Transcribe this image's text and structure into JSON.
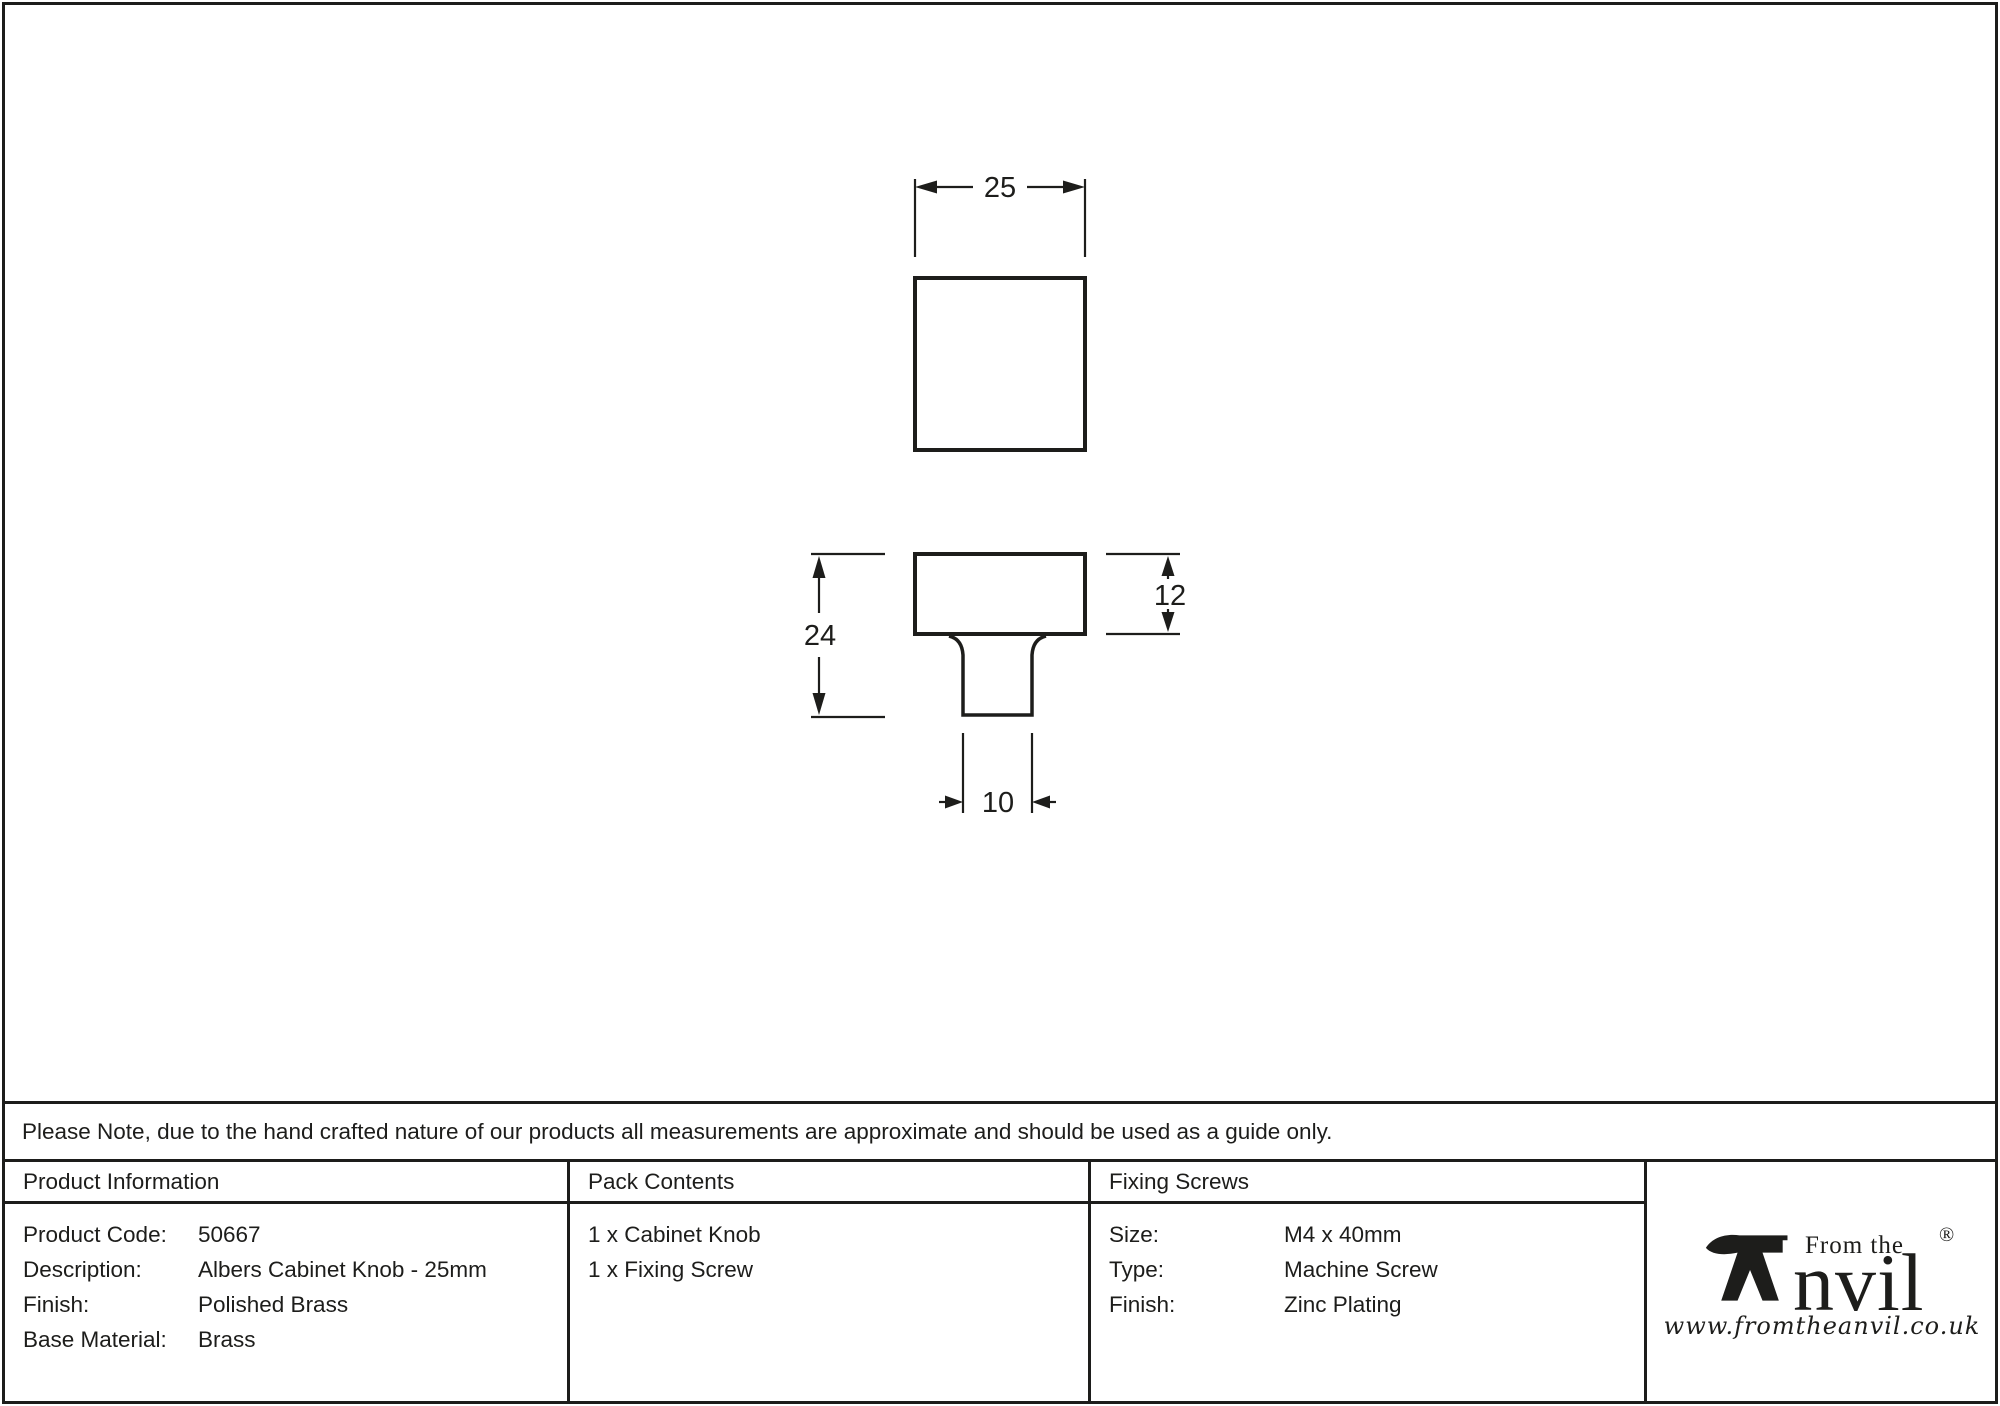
{
  "note": "Please Note, due to the hand crafted nature of our products all measurements are approximate and should be used as a guide only.",
  "drawing": {
    "front_view": {
      "width_label": "25"
    },
    "side_view": {
      "overall_height_label": "24",
      "head_depth_label": "12",
      "stem_width_label": "10"
    }
  },
  "product_information": {
    "header": "Product Information",
    "rows": [
      {
        "label": "Product Code:",
        "value": "50667"
      },
      {
        "label": "Description:",
        "value": "Albers Cabinet Knob - 25mm"
      },
      {
        "label": "Finish:",
        "value": "Polished Brass"
      },
      {
        "label": "Base Material:",
        "value": "Brass"
      }
    ]
  },
  "pack_contents": {
    "header": "Pack Contents",
    "items": [
      "1 x Cabinet Knob",
      "1 x Fixing Screw"
    ]
  },
  "fixing_screws": {
    "header": "Fixing Screws",
    "rows": [
      {
        "label": "Size:",
        "value": "M4 x 40mm"
      },
      {
        "label": "Type:",
        "value": "Machine Screw"
      },
      {
        "label": "Finish:",
        "value": "Zinc Plating"
      }
    ]
  },
  "logo": {
    "from_the": "From the",
    "name_rest": "nvil",
    "registered": "®",
    "url": "www.fromtheanvil.co.uk"
  },
  "colors": {
    "ink": "#1d1d1b",
    "background": "#ffffff"
  }
}
